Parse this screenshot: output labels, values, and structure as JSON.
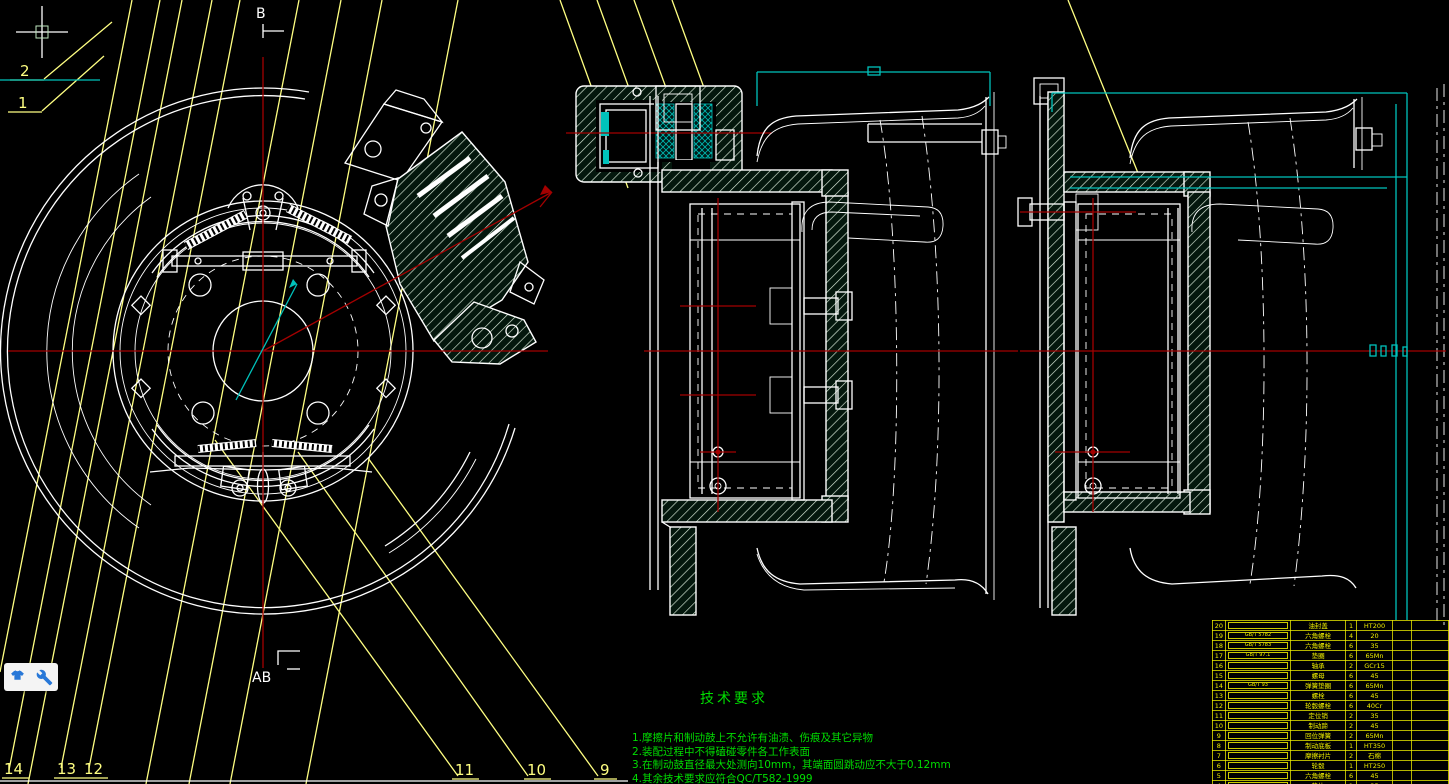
{
  "canvas": {
    "background": "#000000",
    "width": 1449,
    "height": 784
  },
  "colors": {
    "line": "#ffffff",
    "aux": "#ffff82",
    "center": "#a40000",
    "dim": "#00c2bb",
    "green": "#00dd00",
    "table": "#f0f000",
    "iconblue": "#2878d8",
    "redline": "#b23222"
  },
  "view_labels": {
    "section_top": "B",
    "section_bottom": "AB"
  },
  "balloons": {
    "b1": "1",
    "b2": "2",
    "b9": "9",
    "b10": "10",
    "b11": "11",
    "b12": "12",
    "b13": "13",
    "b14": "14"
  },
  "tech_requirements": {
    "title": "技术要求",
    "items": [
      "1.摩擦片和制动鼓上不允许有油渍、伤痕及其它异物",
      "2.装配过程中不得磕碰零件各工作表面",
      "3.在制动鼓直径最大处测向10mm，其端面圆跳动应不大于0.12mm",
      "4.其余技术要求应符合QC/T582-1999",
      "5.制动器装配后应进行磨合试验，不得有卡滞现象"
    ]
  },
  "parts_table": {
    "rows": [
      {
        "no": "20",
        "code": "",
        "name": "油封盖",
        "qty": "1",
        "material": "HT200"
      },
      {
        "no": "19",
        "code": "GB/T 5782",
        "name": "六角螺栓",
        "qty": "4",
        "material": "20"
      },
      {
        "no": "18",
        "code": "GB/T 5783",
        "name": "六角螺栓",
        "qty": "6",
        "material": "35"
      },
      {
        "no": "17",
        "code": "GB/T 97.1",
        "name": "垫圈",
        "qty": "6",
        "material": "65Mn"
      },
      {
        "no": "16",
        "code": "",
        "name": "轴承",
        "qty": "2",
        "material": "GCr15"
      },
      {
        "no": "15",
        "code": "",
        "name": "螺母",
        "qty": "6",
        "material": "45"
      },
      {
        "no": "14",
        "code": "GB/T 93",
        "name": "弹簧垫圈",
        "qty": "6",
        "material": "65Mn"
      },
      {
        "no": "13",
        "code": "",
        "name": "螺栓",
        "qty": "6",
        "material": "45"
      },
      {
        "no": "12",
        "code": "",
        "name": "轮毂螺栓",
        "qty": "6",
        "material": "40Cr"
      },
      {
        "no": "11",
        "code": "",
        "name": "定位销",
        "qty": "2",
        "material": "35"
      },
      {
        "no": "10",
        "code": "",
        "name": "制动蹄",
        "qty": "2",
        "material": "45"
      },
      {
        "no": "9",
        "code": "",
        "name": "回位弹簧",
        "qty": "2",
        "material": "65Mn"
      },
      {
        "no": "8",
        "code": "",
        "name": "制动底板",
        "qty": "1",
        "material": "HT350"
      },
      {
        "no": "7",
        "code": "",
        "name": "摩擦衬片",
        "qty": "2",
        "material": "石棉"
      },
      {
        "no": "6",
        "code": "",
        "name": "轮毂",
        "qty": "1",
        "material": "HT250"
      },
      {
        "no": "5",
        "code": "",
        "name": "六角螺栓",
        "qty": "6",
        "material": "45"
      },
      {
        "no": "4",
        "code": "",
        "name": "垫片",
        "qty": "1",
        "material": "35"
      },
      {
        "no": "3",
        "code": "",
        "name": "制动蹄总成",
        "qty": "1",
        "material": "组合件"
      }
    ]
  },
  "overlay": {
    "icons": [
      "tshirt-icon",
      "wrench-icon"
    ]
  }
}
